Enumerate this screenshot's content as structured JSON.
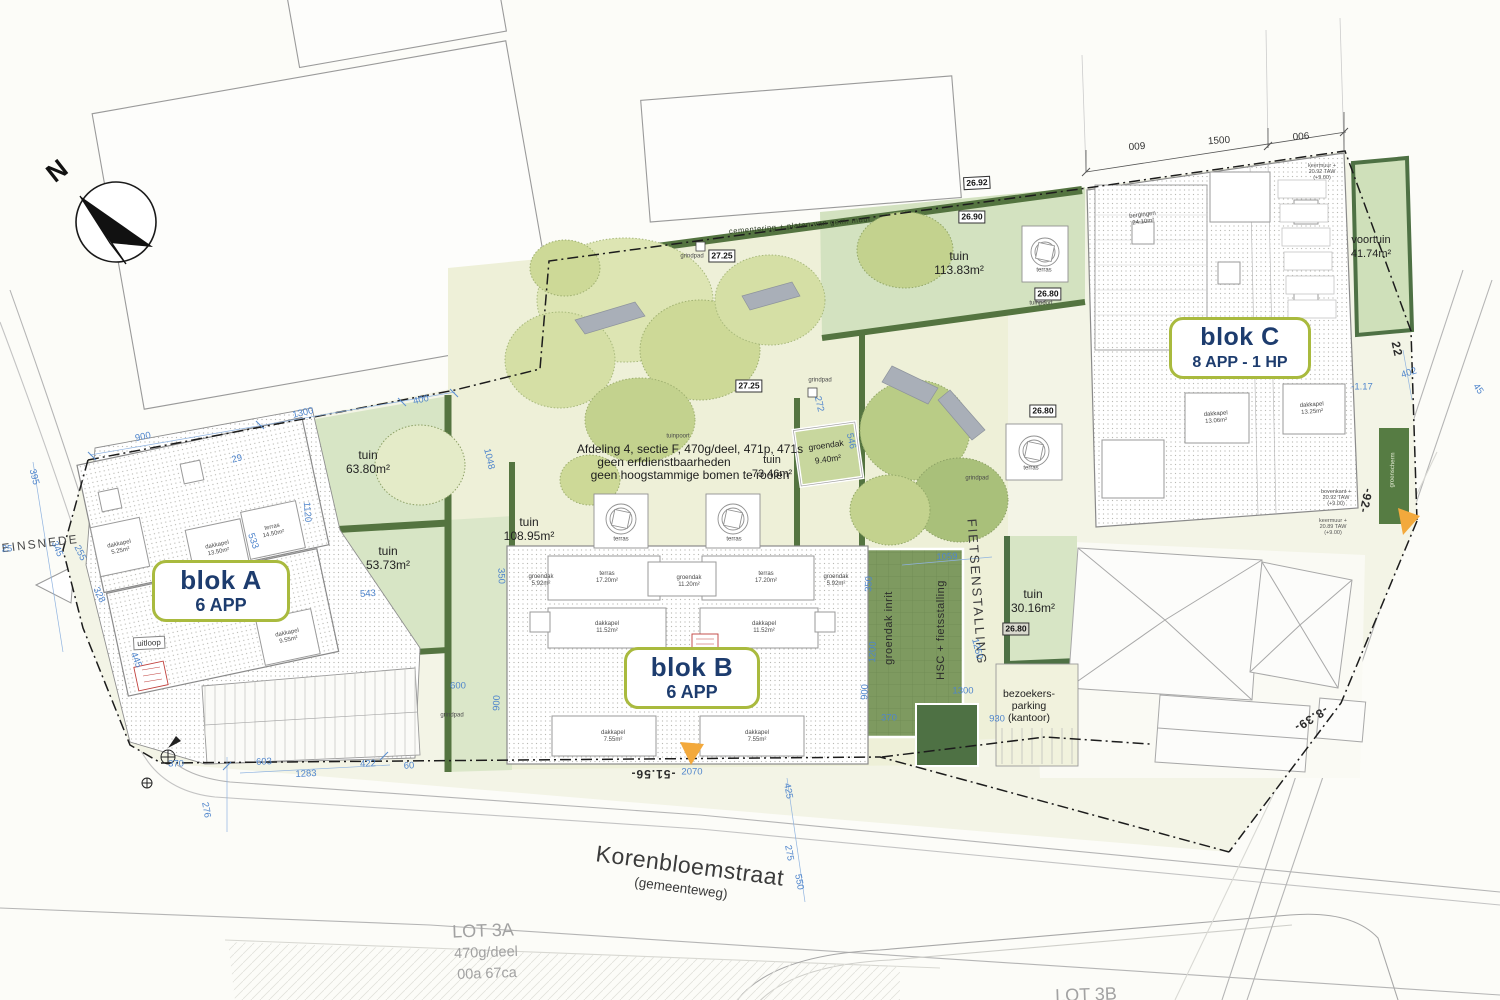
{
  "colors": {
    "accent_olive": "#a9ba3e",
    "navy": "#1d3c6e",
    "garden_green": "#d7e5c5",
    "courtyard": "#eef0d8",
    "hedge_green": "#547440",
    "groendak_green": "#7e9a60",
    "dark_green": "#4e7144",
    "dim_blue": "#4f85cc",
    "marker_yellow": "#f3a93c",
    "stamp_red": "#c0403c"
  },
  "compass": {
    "letter": "N"
  },
  "blocks": [
    {
      "title": "blok A",
      "subtitle": "6 APP"
    },
    {
      "title": "blok B",
      "subtitle": "6 APP"
    },
    {
      "title": "blok C",
      "subtitle": "8 APP - 1 HP"
    }
  ],
  "annotations": [
    {
      "n": "north-letter",
      "c": "north",
      "x": 57,
      "y": 171,
      "r": -38,
      "t": "N"
    },
    {
      "n": "street-name",
      "c": "street",
      "x": 690,
      "y": 866,
      "r": 7.5,
      "t": "Korenbloemstraat"
    },
    {
      "n": "street-type",
      "c": "streetsub",
      "x": 681,
      "y": 888,
      "r": 7.5,
      "t": "(gemeenteweg)"
    },
    {
      "n": "street-name-terreinsnede",
      "c": "terrein",
      "x": 20,
      "y": 546,
      "r": -7,
      "t": "TERREINSNEDE"
    },
    {
      "n": "lot-3a-title",
      "c": "lot",
      "x": 483,
      "y": 931,
      "r": -2,
      "t": "LOT 3A"
    },
    {
      "n": "lot-3a-line2",
      "c": "lotsub",
      "x": 486,
      "y": 953,
      "r": -2,
      "t": "470g/deel"
    },
    {
      "n": "lot-3a-line3",
      "c": "lotsub",
      "x": 487,
      "y": 974,
      "r": -2,
      "t": "00a 67ca"
    },
    {
      "n": "lot-3b-title",
      "c": "lot",
      "x": 1086,
      "y": 995,
      "r": -2,
      "t": "LOT 3B"
    },
    {
      "n": "site-note-line1",
      "c": "note",
      "x": 690,
      "y": 449,
      "t": "Afdeling 4, sectie F, 470g/deel, 471p, 471s"
    },
    {
      "n": "site-note-line2",
      "c": "note",
      "x": 664,
      "y": 462,
      "t": "geen erfdienstbaarheden"
    },
    {
      "n": "site-note-line3",
      "c": "note",
      "x": 690,
      "y": 475,
      "t": "geen hoogstammige bomen te rooien"
    },
    {
      "n": "garden-label-tuin-73",
      "c": "tuin",
      "x": 772,
      "y": 467,
      "fs": 11,
      "l": [
        "tuin",
        "73.46m²"
      ]
    },
    {
      "n": "garden-label-tuin-63",
      "c": "tuin",
      "x": 368,
      "y": 462,
      "l": [
        "tuin",
        "63.80m²"
      ]
    },
    {
      "n": "garden-label-tuin-53",
      "c": "tuin",
      "x": 388,
      "y": 558,
      "l": [
        "tuin",
        "53.73m²"
      ]
    },
    {
      "n": "garden-label-tuin-108",
      "c": "tuin",
      "x": 529,
      "y": 529,
      "l": [
        "tuin",
        "108.95m²"
      ]
    },
    {
      "n": "garden-label-tuin-113",
      "c": "tuin",
      "x": 959,
      "y": 263,
      "l": [
        "tuin",
        "113.83m²"
      ]
    },
    {
      "n": "garden-label-tuin-30",
      "c": "tuin",
      "x": 1033,
      "y": 601,
      "l": [
        "tuin",
        "30.16m²"
      ]
    },
    {
      "n": "garden-label-voortuin",
      "c": "tuin",
      "x": 1371,
      "y": 247,
      "fs": 11,
      "l": [
        "voortuin",
        "41.74m²"
      ]
    },
    {
      "n": "groendak-label",
      "c": "tuin",
      "x": 827,
      "y": 452,
      "r": -8,
      "fs": 8.5,
      "l": [
        "groendak",
        "9.40m²"
      ]
    },
    {
      "n": "fietsenstalling-label",
      "c": "fiets",
      "x": 977,
      "y": 592,
      "r": 86,
      "t": "FIETSENSTALLING"
    },
    {
      "n": "hsc-fietsstalling-label",
      "c": "vfac",
      "x": 941,
      "y": 630,
      "r": -90,
      "t": "HSC + fietsstalling"
    },
    {
      "n": "groendak-inrit-label",
      "c": "vfac",
      "x": 889,
      "y": 628,
      "r": -90,
      "t": "groendak inrit"
    },
    {
      "n": "bezoekers-parking-label",
      "c": "parklbl",
      "x": 1029,
      "y": 706,
      "l": [
        "bezoekers-",
        "parking",
        "(kantoor)"
      ]
    },
    {
      "n": "boundary-wall-note",
      "c": "hedge",
      "x": 800,
      "y": 225,
      "r": -5,
      "t": "cementering + platen van gem. muur"
    },
    {
      "n": "level-26-92",
      "c": "lvl",
      "x": 977,
      "y": 183,
      "r": -3,
      "t": "26.92"
    },
    {
      "n": "level-26-90",
      "c": "lvl",
      "x": 972,
      "y": 217,
      "t": "26.90"
    },
    {
      "n": "level-27-25-a",
      "c": "lvl",
      "x": 722,
      "y": 256,
      "t": "27.25"
    },
    {
      "n": "level-27-25-b",
      "c": "lvl",
      "x": 749,
      "y": 386,
      "t": "27.25"
    },
    {
      "n": "level-26-80-a",
      "c": "lvl",
      "x": 1048,
      "y": 294,
      "t": "26.80"
    },
    {
      "n": "level-26-80-b",
      "c": "lvl",
      "x": 1043,
      "y": 411,
      "t": "26.80"
    },
    {
      "n": "level-26-80-c",
      "c": "lvl2",
      "x": 1016,
      "y": 629,
      "t": "26.80"
    },
    {
      "n": "chainage-51-56",
      "c": "chain",
      "x": 653,
      "y": 774,
      "r": 180,
      "t": "-51.56-"
    },
    {
      "n": "chainage-92",
      "c": "chain",
      "x": 1366,
      "y": 501,
      "r": 102,
      "t": "-92-"
    },
    {
      "n": "chainage-8-39",
      "c": "chain",
      "x": 1311,
      "y": 719,
      "r": 148,
      "t": "-8.39-"
    },
    {
      "n": "chainage-22",
      "c": "chain",
      "x": 1397,
      "y": 349,
      "r": 78,
      "t": "22"
    },
    {
      "n": "dim-009",
      "c": "dimk",
      "x": 1137,
      "y": 147,
      "r": -4,
      "t": "009"
    },
    {
      "n": "dim-1500",
      "c": "dimk",
      "x": 1219,
      "y": 141,
      "r": -4,
      "t": "1500"
    },
    {
      "n": "dim-006",
      "c": "dimk",
      "x": 1301,
      "y": 137,
      "r": -4,
      "t": "006"
    },
    {
      "n": "dim-900-top",
      "c": "dim",
      "x": 143,
      "y": 437,
      "r": -12,
      "t": "900"
    },
    {
      "n": "dim-1300-top",
      "c": "dim",
      "x": 303,
      "y": 413,
      "r": -13,
      "t": "1300"
    },
    {
      "n": "dim-400-top",
      "c": "dim",
      "x": 421,
      "y": 400,
      "r": -13,
      "t": "400"
    },
    {
      "n": "dim-395",
      "c": "dim",
      "x": 34,
      "y": 477,
      "r": 76,
      "t": "395"
    },
    {
      "n": "dim-345",
      "c": "dim",
      "x": 57,
      "y": 549,
      "r": 67,
      "t": "345"
    },
    {
      "n": "dim-255",
      "c": "dim",
      "x": 80,
      "y": 553,
      "r": 64,
      "t": "255"
    },
    {
      "n": "dim-328",
      "c": "dim",
      "x": 99,
      "y": 595,
      "r": 64,
      "t": "328"
    },
    {
      "n": "dim-445",
      "c": "dim",
      "x": 136,
      "y": 660,
      "r": 68,
      "t": "445"
    },
    {
      "n": "dim-25",
      "c": "dim",
      "x": 7,
      "y": 549,
      "t": "25"
    },
    {
      "n": "dim-29",
      "c": "dim",
      "x": 237,
      "y": 459,
      "r": -15,
      "t": "29"
    },
    {
      "n": "dim-533",
      "c": "dim",
      "x": 253,
      "y": 541,
      "r": 70,
      "t": "533"
    },
    {
      "n": "dim-1120",
      "c": "dim",
      "x": 307,
      "y": 512,
      "r": 86,
      "t": "1120"
    },
    {
      "n": "dim-543",
      "c": "dim",
      "x": 368,
      "y": 594,
      "r": -4,
      "t": "543"
    },
    {
      "n": "dim-1048",
      "c": "dim",
      "x": 489,
      "y": 459,
      "r": 77,
      "t": "1048"
    },
    {
      "n": "dim-350-a",
      "c": "dim",
      "x": 501,
      "y": 576,
      "r": 88,
      "t": "350"
    },
    {
      "n": "dim-600",
      "c": "dim",
      "x": 458,
      "y": 686,
      "t": "600"
    },
    {
      "n": "dim-900-b",
      "c": "dim",
      "x": 497,
      "y": 703,
      "r": -88,
      "t": "900"
    },
    {
      "n": "dim-272",
      "c": "dim",
      "x": 819,
      "y": 404,
      "r": 77,
      "t": "272"
    },
    {
      "n": "dim-546",
      "c": "dim",
      "x": 851,
      "y": 441,
      "r": 77,
      "t": "546"
    },
    {
      "n": "dim-350-b",
      "c": "dim",
      "x": 869,
      "y": 584,
      "r": -88,
      "t": "350"
    },
    {
      "n": "dim-1200",
      "c": "dim",
      "x": 873,
      "y": 652,
      "r": -88,
      "t": "1200"
    },
    {
      "n": "dim-900-c",
      "c": "dim",
      "x": 865,
      "y": 692,
      "r": -88,
      "t": "900"
    },
    {
      "n": "dim-1059",
      "c": "dim",
      "x": 947,
      "y": 557,
      "r": -3,
      "t": "1059"
    },
    {
      "n": "dim-1250",
      "c": "dim",
      "x": 977,
      "y": 649,
      "r": 77,
      "t": "1250"
    },
    {
      "n": "dim-1300-b",
      "c": "dim",
      "x": 963,
      "y": 691,
      "t": "1300"
    },
    {
      "n": "dim-370-a",
      "c": "dim",
      "x": 889,
      "y": 718,
      "t": "370"
    },
    {
      "n": "dim-930",
      "c": "dim",
      "x": 997,
      "y": 719,
      "t": "930"
    },
    {
      "n": "dim-2070",
      "c": "dim",
      "x": 692,
      "y": 772,
      "t": "2070"
    },
    {
      "n": "dim-425",
      "c": "dim",
      "x": 788,
      "y": 791,
      "r": 80,
      "t": "425"
    },
    {
      "n": "dim-275",
      "c": "dim",
      "x": 789,
      "y": 853,
      "r": 80,
      "t": "275"
    },
    {
      "n": "dim-550",
      "c": "dim",
      "x": 799,
      "y": 882,
      "r": 80,
      "t": "550"
    },
    {
      "n": "dim-276",
      "c": "dim",
      "x": 206,
      "y": 810,
      "r": 80,
      "t": "276"
    },
    {
      "n": "dim-370-b",
      "c": "dim",
      "x": 176,
      "y": 764,
      "t": "370"
    },
    {
      "n": "dim-603",
      "c": "dim",
      "x": 264,
      "y": 762,
      "r": -3,
      "t": "603"
    },
    {
      "n": "dim-1283",
      "c": "dim",
      "x": 306,
      "y": 774,
      "r": -3,
      "t": "1283"
    },
    {
      "n": "dim-422",
      "c": "dim",
      "x": 368,
      "y": 764,
      "r": -3,
      "t": "422"
    },
    {
      "n": "dim-60",
      "c": "dim",
      "x": 409,
      "y": 766,
      "r": -3,
      "t": "60"
    },
    {
      "n": "dim-402",
      "c": "dim",
      "x": 1409,
      "y": 373,
      "r": -18,
      "t": "402"
    },
    {
      "n": "dim-45",
      "c": "dim",
      "x": 1478,
      "y": 389,
      "r": 55,
      "t": "45"
    },
    {
      "n": "dim-1-17",
      "c": "dim",
      "x": 1362,
      "y": 387,
      "t": "-1.17"
    },
    {
      "n": "grindpad-label-1",
      "c": "tiny",
      "x": 692,
      "y": 257,
      "t": "grindpad"
    },
    {
      "n": "grindpad-label-2",
      "c": "tiny",
      "x": 820,
      "y": 381,
      "t": "grindpad"
    },
    {
      "n": "grindpad-label-3",
      "c": "tiny",
      "x": 977,
      "y": 479,
      "t": "grindpad"
    },
    {
      "n": "grindpad-label-4",
      "c": "tiny",
      "x": 452,
      "y": 716,
      "t": "grindpad"
    },
    {
      "n": "tuinpoort-label-1",
      "c": "tiny",
      "x": 1041,
      "y": 304,
      "t": "tuinpoort"
    },
    {
      "n": "tuinpoort-label-2",
      "c": "tiny",
      "x": 678,
      "y": 437,
      "t": "tuinpoort"
    },
    {
      "n": "terras-label-1",
      "c": "tiny",
      "x": 1044,
      "y": 271,
      "t": "terras"
    },
    {
      "n": "terras-label-2",
      "c": "tiny",
      "x": 1031,
      "y": 469,
      "t": "terras"
    },
    {
      "n": "terras-label-3",
      "c": "tiny",
      "x": 621,
      "y": 540,
      "t": "terras"
    },
    {
      "n": "terras-label-4",
      "c": "tiny",
      "x": 734,
      "y": 540,
      "t": "terras"
    },
    {
      "n": "blokb-groendak-1",
      "c": "tiny",
      "x": 541,
      "y": 581,
      "l": [
        "groendak",
        "5.92m²"
      ]
    },
    {
      "n": "blokb-terras-1",
      "c": "tiny",
      "x": 607,
      "y": 578,
      "l": [
        "terras",
        "17.20m²"
      ]
    },
    {
      "n": "blokb-groendak-2",
      "c": "tiny",
      "x": 689,
      "y": 582,
      "l": [
        "groendak",
        "11.20m²"
      ]
    },
    {
      "n": "blokb-terras-2",
      "c": "tiny",
      "x": 766,
      "y": 578,
      "l": [
        "terras",
        "17.20m²"
      ]
    },
    {
      "n": "blokb-groendak-3",
      "c": "tiny",
      "x": 836,
      "y": 581,
      "l": [
        "groendak",
        "5.92m²"
      ]
    },
    {
      "n": "blokb-dakkapel-1",
      "c": "tiny",
      "x": 607,
      "y": 628,
      "l": [
        "dakkapel",
        "11.52m²"
      ]
    },
    {
      "n": "blokb-dakkapel-2",
      "c": "tiny",
      "x": 764,
      "y": 628,
      "l": [
        "dakkapel",
        "11.52m²"
      ]
    },
    {
      "n": "blokb-dakkapel-3",
      "c": "tiny",
      "x": 613,
      "y": 737,
      "l": [
        "dakkapel",
        "7.55m²"
      ]
    },
    {
      "n": "blokb-dakkapel-4",
      "c": "tiny",
      "x": 757,
      "y": 737,
      "l": [
        "dakkapel",
        "7.55m²"
      ]
    },
    {
      "n": "bloka-dakkapel-1",
      "c": "tiny",
      "x": 120,
      "y": 548,
      "r": -12,
      "l": [
        "dakkapel",
        "5.25m²"
      ]
    },
    {
      "n": "bloka-dakkapel-2",
      "c": "tiny",
      "x": 218,
      "y": 549,
      "r": -12,
      "l": [
        "dakkapel",
        "13.50m²"
      ]
    },
    {
      "n": "bloka-terras",
      "c": "tiny",
      "x": 273,
      "y": 531,
      "r": -12,
      "l": [
        "terras",
        "14.50m²"
      ]
    },
    {
      "n": "bloka-dakkapel-3",
      "c": "tiny",
      "x": 288,
      "y": 637,
      "r": -12,
      "l": [
        "dakkapel",
        "9.55m²"
      ]
    },
    {
      "n": "uitloop-label",
      "c": "boxlbl",
      "x": 149,
      "y": 643,
      "r": -3,
      "t": "uitloop"
    },
    {
      "n": "blokc-bergingen",
      "c": "tiny",
      "x": 1143,
      "y": 219,
      "r": -7,
      "l": [
        "bergingen",
        "24.10m²"
      ]
    },
    {
      "n": "blokc-dakkapel-1",
      "c": "tiny",
      "x": 1216,
      "y": 418,
      "r": -4,
      "l": [
        "dakkapel",
        "13.06m²"
      ]
    },
    {
      "n": "blokc-dakkapel-2",
      "c": "tiny",
      "x": 1312,
      "y": 409,
      "r": -4,
      "l": [
        "dakkapel",
        "13.25m²"
      ]
    },
    {
      "n": "taw-note-1",
      "c": "taw",
      "x": 1322,
      "y": 172,
      "l": [
        "keermuur +",
        "20.92 TAW",
        "(+9.00)"
      ]
    },
    {
      "n": "taw-note-2",
      "c": "taw",
      "x": 1336,
      "y": 498,
      "l": [
        "bovenkant +",
        "20.92 TAW",
        "(+9.00)"
      ]
    },
    {
      "n": "taw-note-3",
      "c": "taw",
      "x": 1333,
      "y": 527,
      "l": [
        "keermuur +",
        "20.89 TAW",
        "(+9.00)"
      ]
    },
    {
      "n": "groenscherm-label",
      "c": "tinyw",
      "x": 1393,
      "y": 470,
      "r": -88,
      "t": "groenscherm"
    }
  ]
}
